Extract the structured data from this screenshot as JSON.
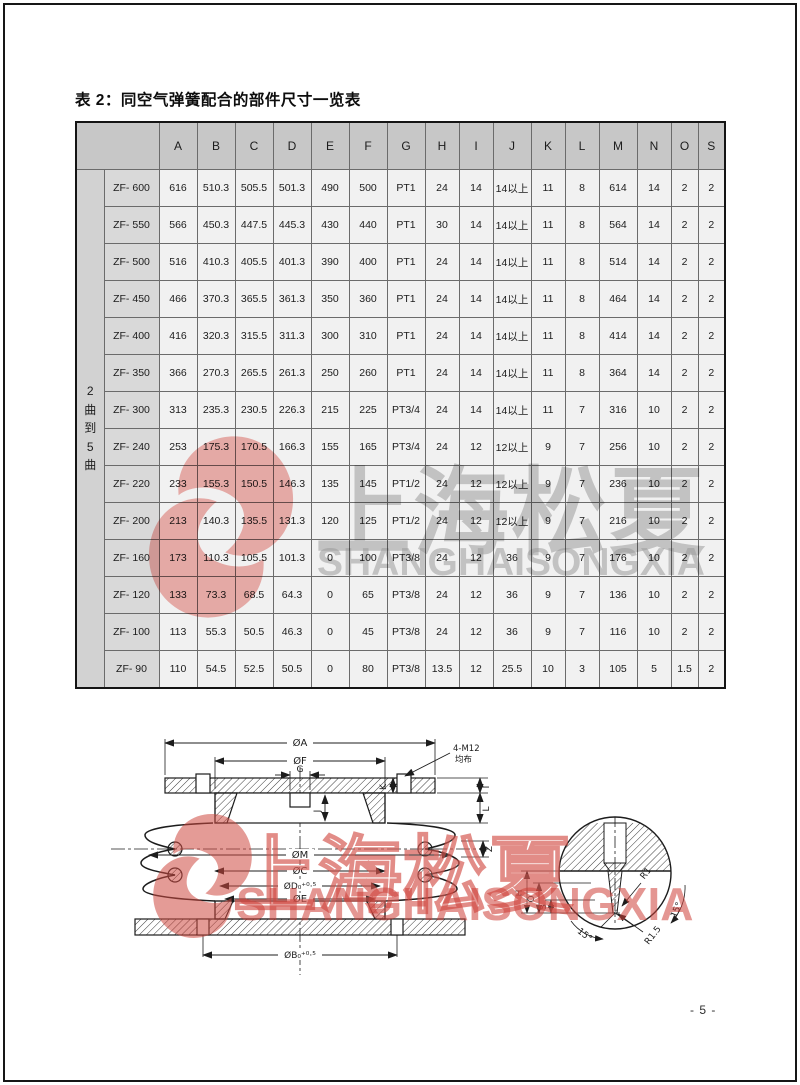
{
  "page": {
    "title": "表 2：同空气弹簧配合的部件尺寸一览表",
    "page_number": "- 5 -"
  },
  "watermark": {
    "cn": "上海松夏",
    "en": "SHANGHAISONGXIA",
    "logo_color_table": "#e2574f",
    "logo_color_diagram": "#cf4a41"
  },
  "table": {
    "group_label": "2曲到5曲",
    "columns": [
      "A",
      "B",
      "C",
      "D",
      "E",
      "F",
      "G",
      "H",
      "I",
      "J",
      "K",
      "L",
      "M",
      "N",
      "O",
      "S"
    ],
    "rows": [
      {
        "model": "ZF- 600",
        "values": [
          "616",
          "510.3",
          "505.5",
          "501.3",
          "490",
          "500",
          "PT1",
          "24",
          "14",
          "14以上",
          "11",
          "8",
          "614",
          "14",
          "2",
          "2"
        ]
      },
      {
        "model": "ZF- 550",
        "values": [
          "566",
          "450.3",
          "447.5",
          "445.3",
          "430",
          "440",
          "PT1",
          "30",
          "14",
          "14以上",
          "11",
          "8",
          "564",
          "14",
          "2",
          "2"
        ]
      },
      {
        "model": "ZF- 500",
        "values": [
          "516",
          "410.3",
          "405.5",
          "401.3",
          "390",
          "400",
          "PT1",
          "24",
          "14",
          "14以上",
          "11",
          "8",
          "514",
          "14",
          "2",
          "2"
        ]
      },
      {
        "model": "ZF- 450",
        "values": [
          "466",
          "370.3",
          "365.5",
          "361.3",
          "350",
          "360",
          "PT1",
          "24",
          "14",
          "14以上",
          "11",
          "8",
          "464",
          "14",
          "2",
          "2"
        ]
      },
      {
        "model": "ZF- 400",
        "values": [
          "416",
          "320.3",
          "315.5",
          "311.3",
          "300",
          "310",
          "PT1",
          "24",
          "14",
          "14以上",
          "11",
          "8",
          "414",
          "14",
          "2",
          "2"
        ]
      },
      {
        "model": "ZF- 350",
        "values": [
          "366",
          "270.3",
          "265.5",
          "261.3",
          "250",
          "260",
          "PT1",
          "24",
          "14",
          "14以上",
          "11",
          "8",
          "364",
          "14",
          "2",
          "2"
        ]
      },
      {
        "model": "ZF- 300",
        "values": [
          "313",
          "235.3",
          "230.5",
          "226.3",
          "215",
          "225",
          "PT3/4",
          "24",
          "14",
          "14以上",
          "11",
          "7",
          "316",
          "10",
          "2",
          "2"
        ]
      },
      {
        "model": "ZF- 240",
        "values": [
          "253",
          "175.3",
          "170.5",
          "166.3",
          "155",
          "165",
          "PT3/4",
          "24",
          "12",
          "12以上",
          "9",
          "7",
          "256",
          "10",
          "2",
          "2"
        ]
      },
      {
        "model": "ZF- 220",
        "values": [
          "233",
          "155.3",
          "150.5",
          "146.3",
          "135",
          "145",
          "PT1/2",
          "24",
          "12",
          "12以上",
          "9",
          "7",
          "236",
          "10",
          "2",
          "2"
        ]
      },
      {
        "model": "ZF- 200",
        "values": [
          "213",
          "140.3",
          "135.5",
          "131.3",
          "120",
          "125",
          "PT1/2",
          "24",
          "12",
          "12以上",
          "9",
          "7",
          "216",
          "10",
          "2",
          "2"
        ]
      },
      {
        "model": "ZF- 160",
        "values": [
          "173",
          "110.3",
          "105.5",
          "101.3",
          "0",
          "100",
          "PT3/8",
          "24",
          "12",
          "36",
          "9",
          "7",
          "176",
          "10",
          "2",
          "2"
        ]
      },
      {
        "model": "ZF- 120",
        "values": [
          "133",
          "73.3",
          "68.5",
          "64.3",
          "0",
          "65",
          "PT3/8",
          "24",
          "12",
          "36",
          "9",
          "7",
          "136",
          "10",
          "2",
          "2"
        ]
      },
      {
        "model": "ZF- 100",
        "values": [
          "113",
          "55.3",
          "50.5",
          "46.3",
          "0",
          "45",
          "PT3/8",
          "24",
          "12",
          "36",
          "9",
          "7",
          "116",
          "10",
          "2",
          "2"
        ]
      },
      {
        "model": "ZF- 90",
        "values": [
          "110",
          "54.5",
          "52.5",
          "50.5",
          "0",
          "80",
          "PT3/8",
          "13.5",
          "12",
          "25.5",
          "10",
          "3",
          "105",
          "5",
          "1.5",
          "2"
        ]
      }
    ]
  },
  "diagram": {
    "dims": {
      "a": "ØA",
      "f": "ØF",
      "g": "G",
      "m": "ØM",
      "c": "ØC",
      "d": "ØD₀⁺⁰·⁵",
      "e": "ØE",
      "b": "ØB₀⁺⁰·⁵",
      "i": "I",
      "l": "L",
      "z": "Z",
      "k": "K",
      "j": "J",
      "bolt1": "4-M12",
      "bolt2": "均布"
    },
    "detail": {
      "h": "H",
      "o": "O",
      "s": "S",
      "r1": "R1",
      "r15": "R1.5",
      "a1": "15°",
      "a2": "15°"
    }
  }
}
